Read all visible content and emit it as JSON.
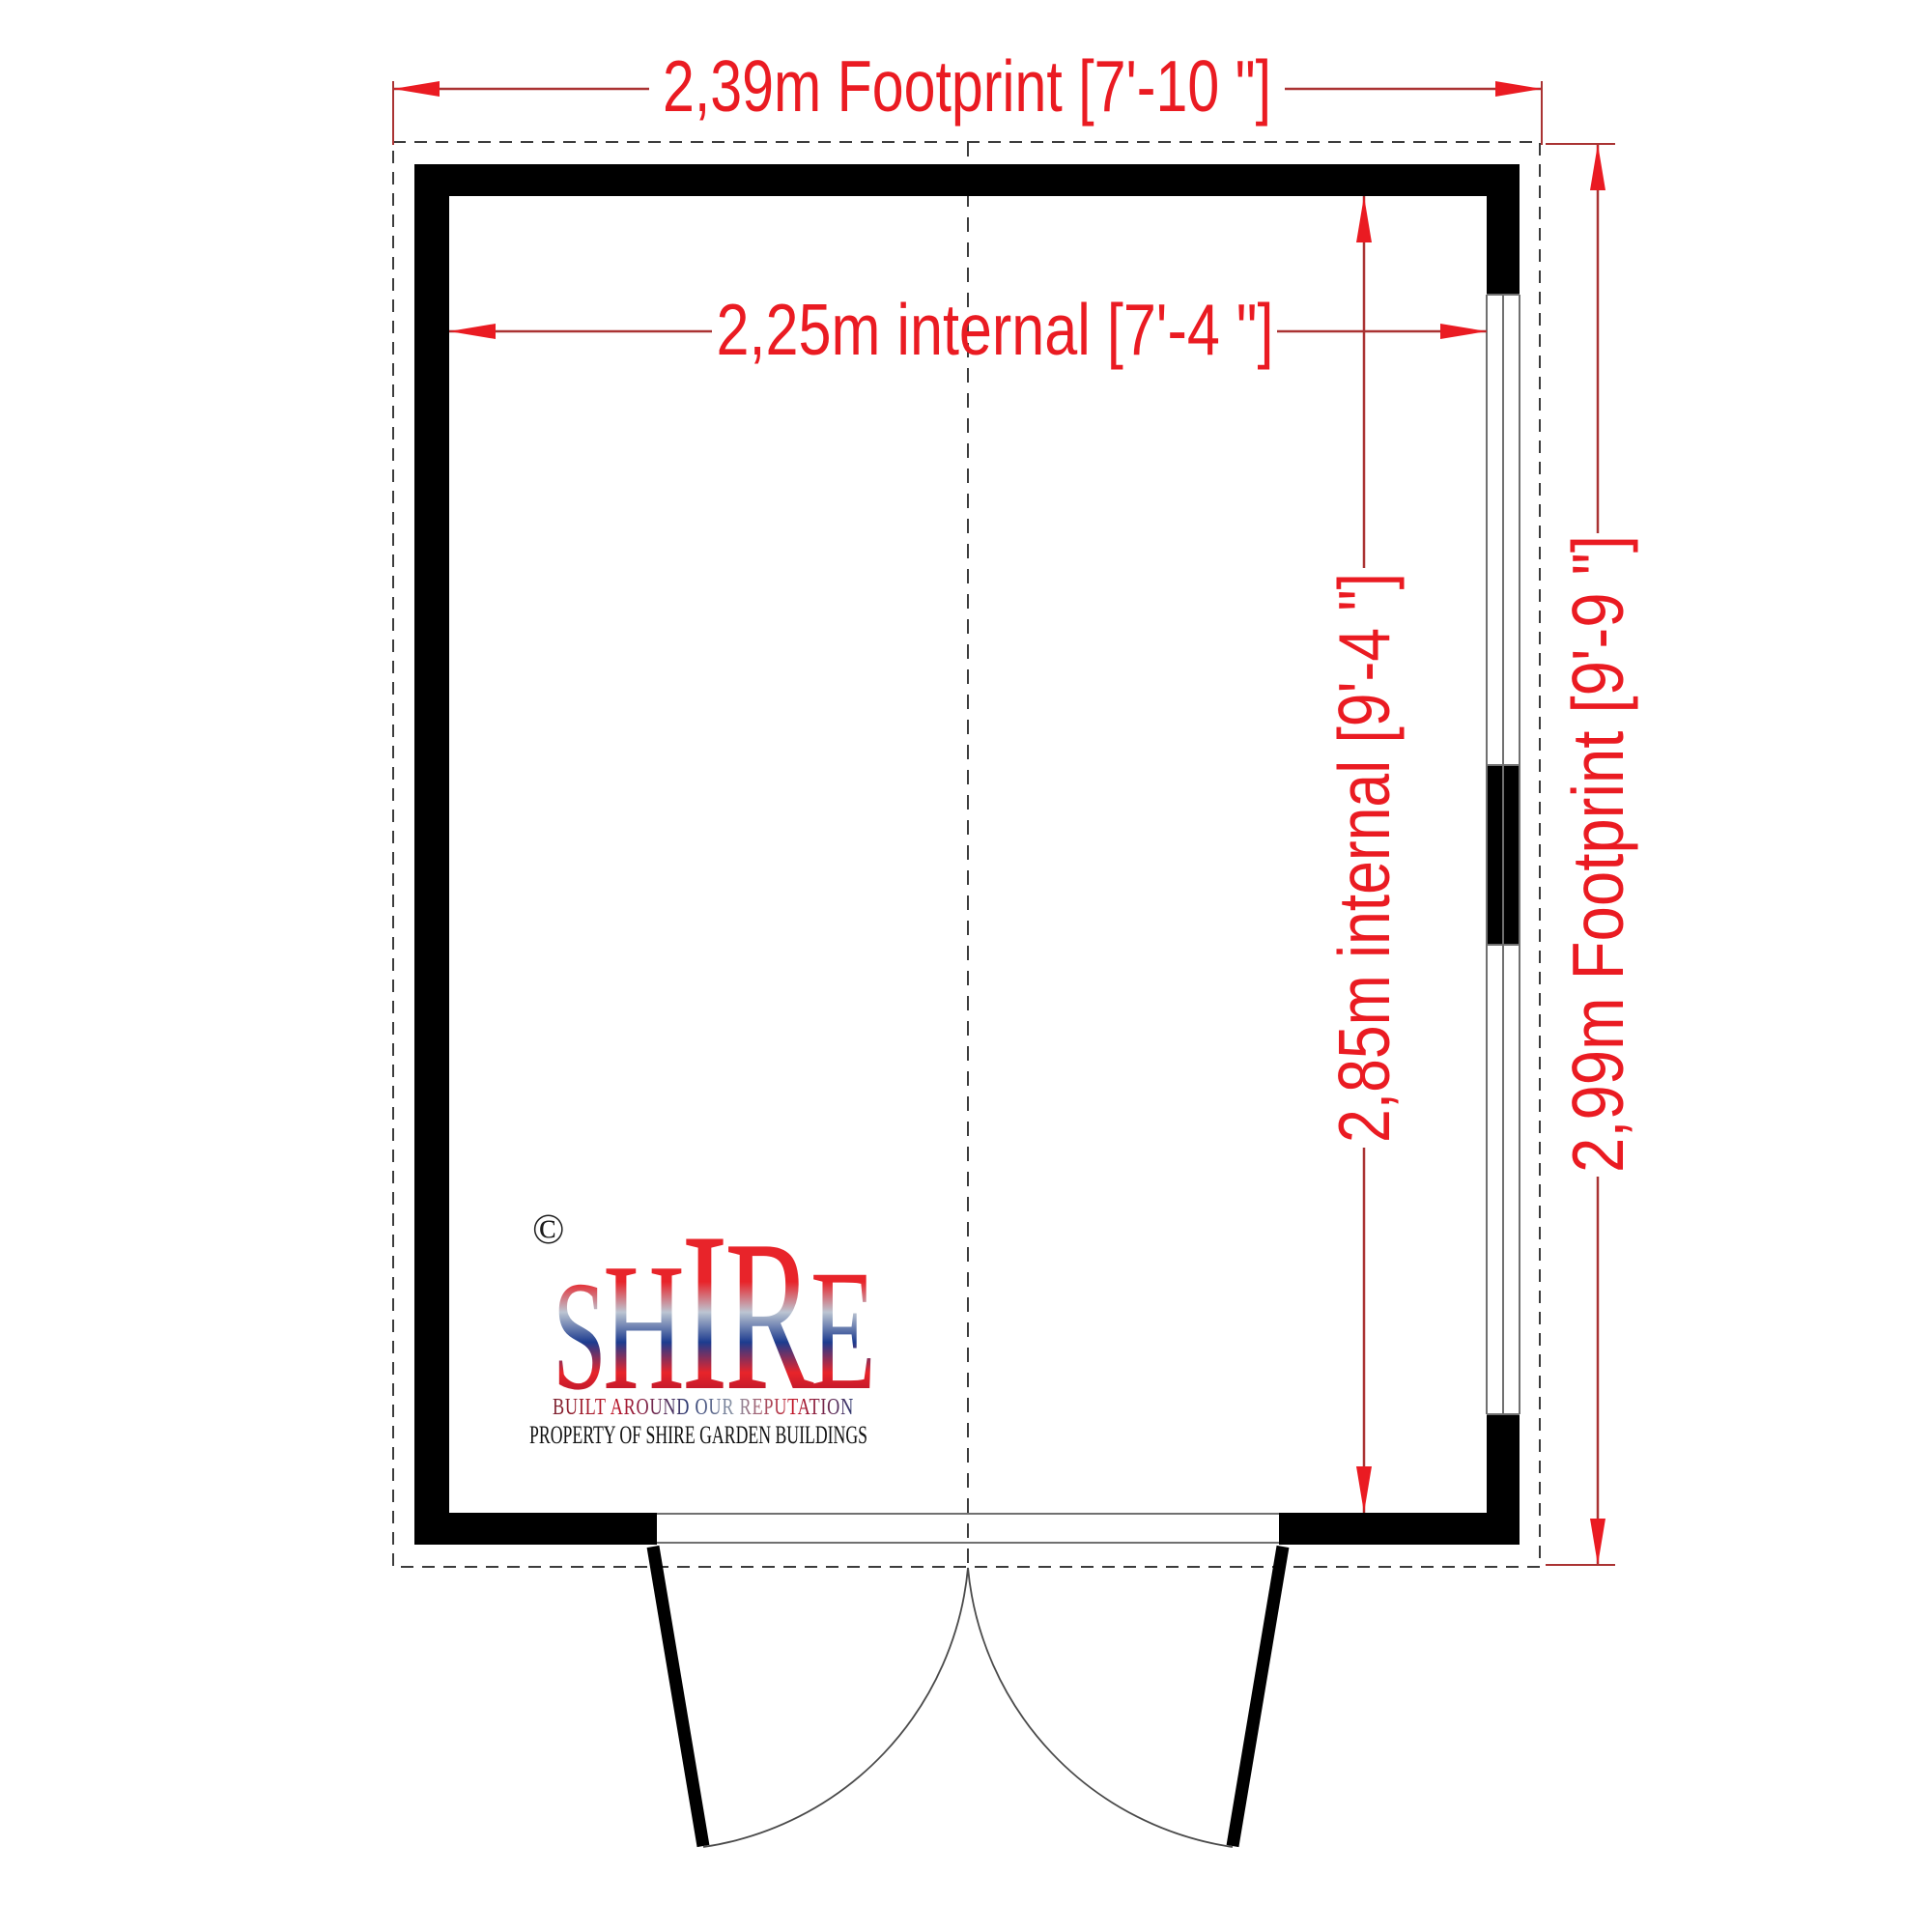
{
  "drawing": {
    "type": "shed floor plan",
    "dims": {
      "footprint_width": {
        "label": "2,39m Footprint [7'-10 \"]"
      },
      "internal_width": {
        "label": "2,25m internal  [7'-4 \"]"
      },
      "internal_height": {
        "label": "2,85m internal  [9'-4 \"]"
      },
      "footprint_height": {
        "label": "2,99m Footprint [9'-9 \"]"
      }
    }
  },
  "logo": {
    "copyright": "©",
    "letters": [
      "S",
      "H",
      "I",
      "R",
      "E"
    ],
    "tagline": "BUILT AROUND OUR REPUTATION",
    "property": "PROPERTY OF SHIRE GARDEN BUILDINGS"
  },
  "colors": {
    "dimension_text": "#ea1b22",
    "dimension_line": "#aa3333",
    "wall": "#000000",
    "drawing_gray": "#707070",
    "arc": "#4a4a4a",
    "dashed": "#3c3c3c",
    "logo_red": "#e8242a",
    "logo_blue": "#1d3c8f",
    "logo_silver": "#bcc5d2"
  }
}
